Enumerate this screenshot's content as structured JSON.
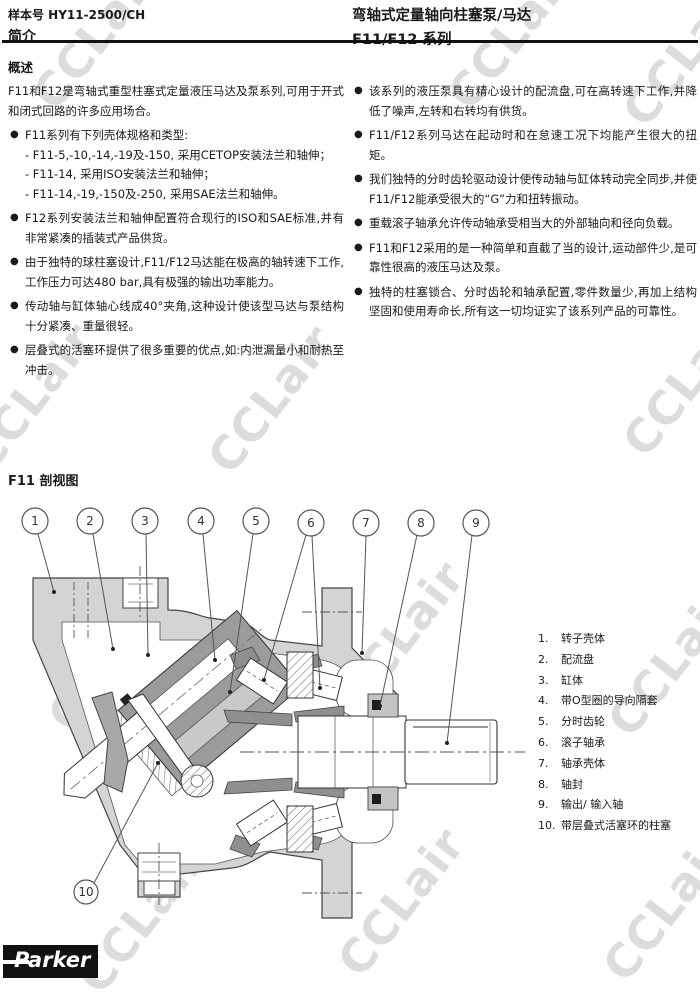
{
  "header": {
    "doc_number": "样本号 HY11-2500/CH",
    "section": "简介",
    "title_line1": "弯轴式定量轴向柱塞泵/马达",
    "title_line2": "F11/F12 系列"
  },
  "overview": {
    "heading": "概述",
    "intro": "F11和F12是弯轴式重型柱塞式定量液压马达及泵系列,可用于开式和闭式回路的许多应用场合。",
    "left_bullets": [
      {
        "text": "F11系列有下列壳体规格和类型:",
        "sub": [
          "- F11-5,-10,-14,-19及-150, 采用CETOP安装法兰和轴伸；",
          "- F11-14, 采用ISO安装法兰和轴伸；",
          "- F11-14,-19,-150及-250, 采用SAE法兰和轴伸。"
        ]
      },
      {
        "text": "F12系列安装法兰和轴伸配置符合现行的ISO和SAE标准,并有非常紧凑的插装式产品供货。"
      },
      {
        "text": "由于独特的球柱塞设计,F11/F12马达能在极高的轴转速下工作,工作压力可达480 bar,具有极强的输出功率能力。"
      },
      {
        "text": "传动轴与缸体轴心线成40°夹角,这种设计使该型马达与泵结构十分紧凑、重量很轻。"
      },
      {
        "text": "层叠式的活塞环提供了很多重要的优点,如:内泄漏量小和耐热至冲击。"
      }
    ],
    "right_bullets": [
      {
        "text": "该系列的液压泵具有精心设计的配流盘,可在高转速下工作,并降低了噪声,左转和右转均有供货。"
      },
      {
        "text": "F11/F12系列马达在起动时和在怠速工况下均能产生很大的扭矩。"
      },
      {
        "text": "我们独特的分时齿轮驱动设计使传动轴与缸体转动完全同步,并使F11/F12能承受很大的“G”力和扭转振动。"
      },
      {
        "text": "重载滚子轴承允许传动轴承受相当大的外部轴向和径向负载。"
      },
      {
        "text": "F11和F12采用的是一种简单和直截了当的设计,运动部件少,是可靠性很高的液压马达及泵。"
      },
      {
        "text": "独特的柱塞锁合、分时齿轮和轴承配置,零件数量少,再加上结构坚固和使用寿命长,所有这一切均证实了该系列产品的可靠性。"
      }
    ]
  },
  "figure": {
    "heading": "F11 剖视图",
    "callouts": [
      "1",
      "2",
      "3",
      "4",
      "5",
      "6",
      "7",
      "8",
      "9",
      "10"
    ],
    "legend": [
      {
        "num": "1.",
        "label": "转子壳体"
      },
      {
        "num": "2.",
        "label": "配流盘"
      },
      {
        "num": "3.",
        "label": "缸体"
      },
      {
        "num": "4.",
        "label": "带O型圈的导向隔套"
      },
      {
        "num": "5.",
        "label": "分时齿轮"
      },
      {
        "num": "6.",
        "label": "滚子轴承"
      },
      {
        "num": "7.",
        "label": "轴承壳体"
      },
      {
        "num": "8.",
        "label": "轴封"
      },
      {
        "num": "9.",
        "label": "输出/ 输入轴"
      },
      {
        "num": "10.",
        "label": "带层叠式活塞环的柱塞"
      }
    ]
  },
  "logo": {
    "brand": "Parker"
  },
  "watermark": {
    "text": "CCLair",
    "color": "#dcdcdc"
  }
}
